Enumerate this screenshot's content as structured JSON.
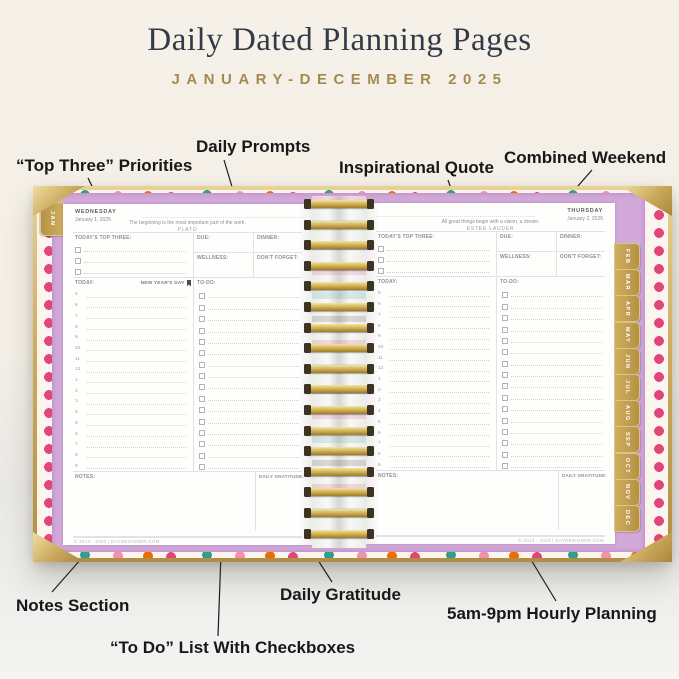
{
  "header": {
    "title": "Daily Dated Planning Pages",
    "subtitle": "JANUARY-DECEMBER 2025"
  },
  "callouts": {
    "top_three": "“Top Three” Priorities",
    "daily_prompts": "Daily Prompts",
    "inspirational_quote": "Inspirational Quote",
    "combined_weekend": "Combined Weekend",
    "notes_section": "Notes Section",
    "todo_list": "“To Do” List With Checkboxes",
    "daily_gratitude": "Daily Gratitude",
    "hourly_planning": "5am-9pm Hourly Planning"
  },
  "planner": {
    "tab_left": "JAN",
    "tabs_right": [
      "FEB",
      "MAR",
      "APR",
      "MAY",
      "JUN",
      "JUL",
      "AUG",
      "SEP",
      "OCT",
      "NOV",
      "DEC"
    ],
    "labels": {
      "top_three": "TODAY'S TOP THREE:",
      "due": "DUE:",
      "dinner": "DINNER:",
      "wellness": "WELLNESS:",
      "dont_forget": "DON'T FORGET:",
      "today": "TODAY:",
      "todo": "TO-DO:",
      "notes": "NOTES:",
      "gratitude": "DAILY GRATITUDE:"
    },
    "hours": [
      "5",
      "6",
      "7",
      "8",
      "9",
      "10",
      "11",
      "12",
      "1",
      "2",
      "3",
      "4",
      "5",
      "6",
      "7",
      "8",
      "9"
    ],
    "left_page": {
      "day_name": "WEDNESDAY",
      "date": "January 1, 2025",
      "quote": "The beginning is the most important part of the work.",
      "quote_author": "PLATO",
      "holiday": "NEW YEAR'S DAY"
    },
    "right_page": {
      "day_name": "THURSDAY",
      "date": "January 2, 2025",
      "quote": "All great things begin with a vision, a dream.",
      "quote_author": "ESTEE LAUDER"
    },
    "copyright": "© 2012 - 2023 | DAYDESIGNER.COM"
  },
  "colors": {
    "title": "#343b48",
    "subtitle_gold": "#a38a50",
    "cover_gold": "#cdab5e",
    "inner_cover_lilac": "#d3a9da",
    "page_white": "#fefefd"
  }
}
